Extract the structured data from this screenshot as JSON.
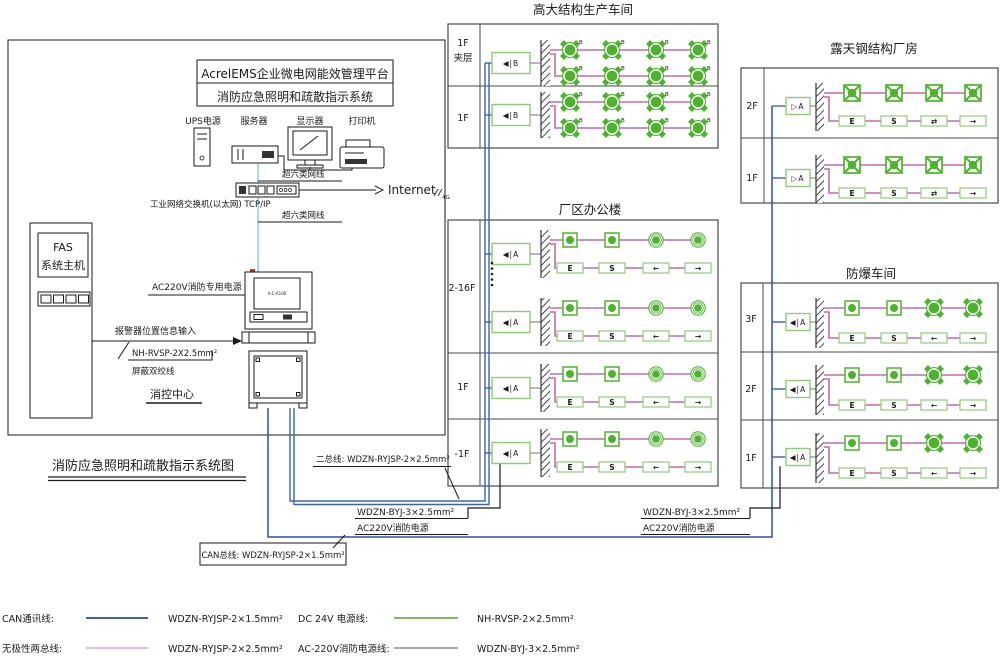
{
  "diagram_title": "消防应急照明和疏散指示系统图",
  "control_room": {
    "platform_line1": "AcrelEMS企业微电网能效管理平台",
    "platform_line2": "消防应急照明和疏散指示系统",
    "device_labels": [
      "UPS电源",
      "服务器",
      "显示器",
      "打印机"
    ],
    "cat6_label_top": "超六类网线",
    "cat6_label_bottom": "超六类网线",
    "switch_label": "工业网络交换机(以太网) TCP/IP",
    "internet_label": "Internet",
    "wireless_label": "4G",
    "fas_line1": "FAS",
    "fas_line2": "系统主机",
    "ac220_dedicated_label": "AC220V消防专用电源",
    "alarm_input_label": "报警器位置信息输入",
    "alarm_cable_spec": "NH-RVSP-2X2.5mm²",
    "alarm_cable_note": "屏蔽双绞线",
    "room_label": "消控中心",
    "workstation_screen_label": "A-C-A100"
  },
  "buildings": [
    {
      "name": "高大结构生产车间",
      "floors": [
        {
          "label": [
            "1F",
            "夹层"
          ],
          "unit": "◀|B",
          "tag": "B",
          "rows": [
            [
              "flood",
              "flood",
              "flood",
              "flood"
            ],
            [
              "flood",
              "flood",
              "flood",
              "flood"
            ]
          ]
        },
        {
          "label": "1F",
          "unit": "◀|B",
          "tag": "B",
          "rows": [
            [
              "flood",
              "flood",
              "flood",
              "flood"
            ],
            [
              "flood",
              "flood",
              "flood",
              "flood"
            ]
          ]
        }
      ]
    },
    {
      "name": "厂区办公楼",
      "floors": [
        {
          "label": "2-16F",
          "unit": "◀|A",
          "rows": [
            [
              "lamp-sq",
              "lamp-sq",
              "lamp-c",
              "lamp-c"
            ],
            [
              "sign:E",
              "sign:S",
              "sign:L",
              "sign:R"
            ]
          ]
        },
        {
          "label": "1F",
          "unit": "◀|A",
          "rows": [
            [
              "lamp-sq",
              "lamp-sq",
              "lamp-c",
              "lamp-c"
            ],
            [
              "sign:E",
              "sign:S",
              "sign:L",
              "sign:R"
            ]
          ]
        },
        {
          "label": "-1F",
          "unit": "◀|A",
          "rows": [
            [
              "lamp-sq",
              "lamp-sq",
              "lamp-c",
              "lamp-c"
            ],
            [
              "sign:E",
              "sign:S",
              "sign:L",
              "sign:R"
            ]
          ]
        }
      ]
    },
    {
      "name": "露天钢结构厂房",
      "floors": [
        {
          "label": "2F",
          "unit": "▷A",
          "rows": [
            [
              "flood-sq",
              "flood-sq",
              "flood-sq",
              "flood-sq"
            ],
            [
              "sign:E",
              "sign:S",
              "sign:LR",
              "sign:R"
            ]
          ]
        },
        {
          "label": "1F",
          "unit": "▷A",
          "rows": [
            [
              "flood-sq",
              "flood-sq",
              "flood-sq",
              "flood-sq"
            ],
            [
              "sign:E",
              "sign:S",
              "sign:LR",
              "sign:R"
            ]
          ]
        }
      ]
    },
    {
      "name": "防爆车间",
      "floors": [
        {
          "label": "3F",
          "unit": "◀|A",
          "rows": [
            [
              "lamp-sq",
              "lamp-sq",
              "flood",
              "flood"
            ],
            [
              "sign:E",
              "sign:S",
              "sign:L",
              "sign:R"
            ]
          ]
        },
        {
          "label": "2F",
          "unit": "◀|A",
          "rows": [
            [
              "lamp-sq",
              "lamp-sq",
              "flood",
              "flood"
            ],
            [
              "sign:E",
              "sign:S",
              "sign:L",
              "sign:R"
            ]
          ]
        },
        {
          "label": "1F",
          "unit": "◀|A",
          "rows": [
            [
              "lamp-sq",
              "lamp-sq",
              "flood",
              "flood"
            ],
            [
              "sign:E",
              "sign:S",
              "sign:L",
              "sign:R"
            ]
          ]
        }
      ]
    }
  ],
  "sign_glyphs": {
    "E": "E",
    "S": "S",
    "L": "←",
    "R": "→",
    "LR": "⇄"
  },
  "callouts": {
    "two_bus": "二总线: WDZN-RYJSP-2×2.5mm²",
    "can_bus": "CAN总线: WDZN-RYJSP-2×1.5mm²",
    "ac_feed_cable_left": "WDZN-BYJ-3×2.5mm²",
    "ac_feed_label_left": "AC220V消防电源",
    "ac_feed_cable_right": "WDZN-BYJ-3×2.5mm²",
    "ac_feed_label_right": "AC220V消防电源"
  },
  "legend": {
    "rows": [
      {
        "label": "CAN通讯线:",
        "spec": "WDZN-RYJSP-2×1.5mm²",
        "color": "#2547a8"
      },
      {
        "label": "无极性两总线:",
        "spec": "WDZN-RYJSP-2×2.5mm²",
        "color": "#ddb4d4"
      },
      {
        "label": "DC 24V 电源线:",
        "spec": "NH-RVSP-2×2.5mm²",
        "color": "#6fb34c"
      },
      {
        "label": "AC-220V消防电源线:",
        "spec": "WDZN-BYJ-3×2.5mm²",
        "color": "#9b9b9b"
      }
    ]
  },
  "colors": {
    "can_bus": "#2a52a8",
    "two_bus": "#3a62b0",
    "floor_wire": "#c06ab2",
    "device_green": "#4db32e",
    "device_border": "#8fca77",
    "network_line": "#8ed2ec",
    "ac_wire": "#1a1a1a"
  }
}
